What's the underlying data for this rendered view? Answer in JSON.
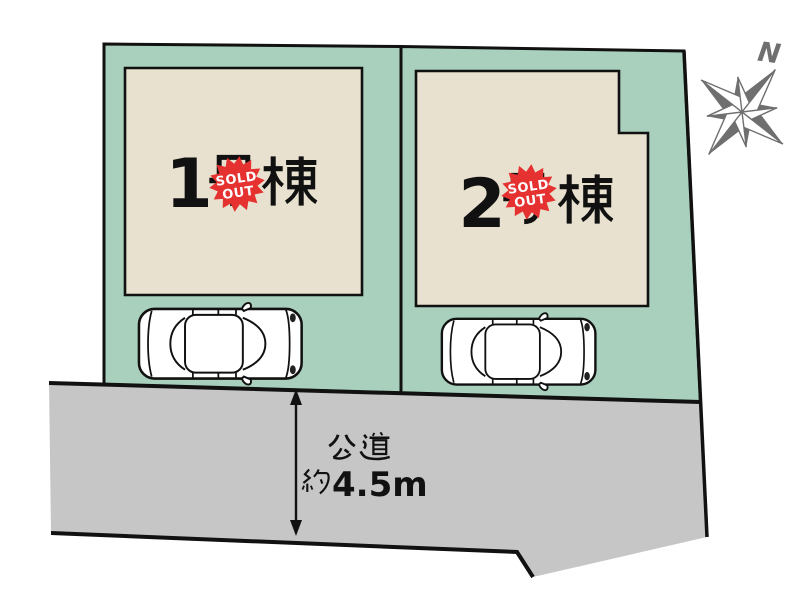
{
  "diagram_title": "分譲地 区画図",
  "plots": [
    {
      "id": "plot-1",
      "label": "1号棟",
      "label_number": "1",
      "label_suffix": "号棟",
      "status": "SOLD OUT"
    },
    {
      "id": "plot-2",
      "label": "2号棟",
      "label_number": "2",
      "label_suffix": "号棟",
      "status": "SOLD OUT"
    }
  ],
  "badge": {
    "line1": "SOLD",
    "line2": "OUT"
  },
  "road": {
    "name": "公道",
    "width": "約4.5m",
    "width_prefix": "約",
    "width_value": "4.5m"
  },
  "compass": {
    "north_label": "N"
  },
  "colors": {
    "plot_green": "#a8d0bd",
    "building_beige": "#e9e1cf",
    "road_gray": "#c6c6c6",
    "badge_red": "#e53230",
    "outline_black": "#111111",
    "compass_gray": "#6f6f6f"
  }
}
